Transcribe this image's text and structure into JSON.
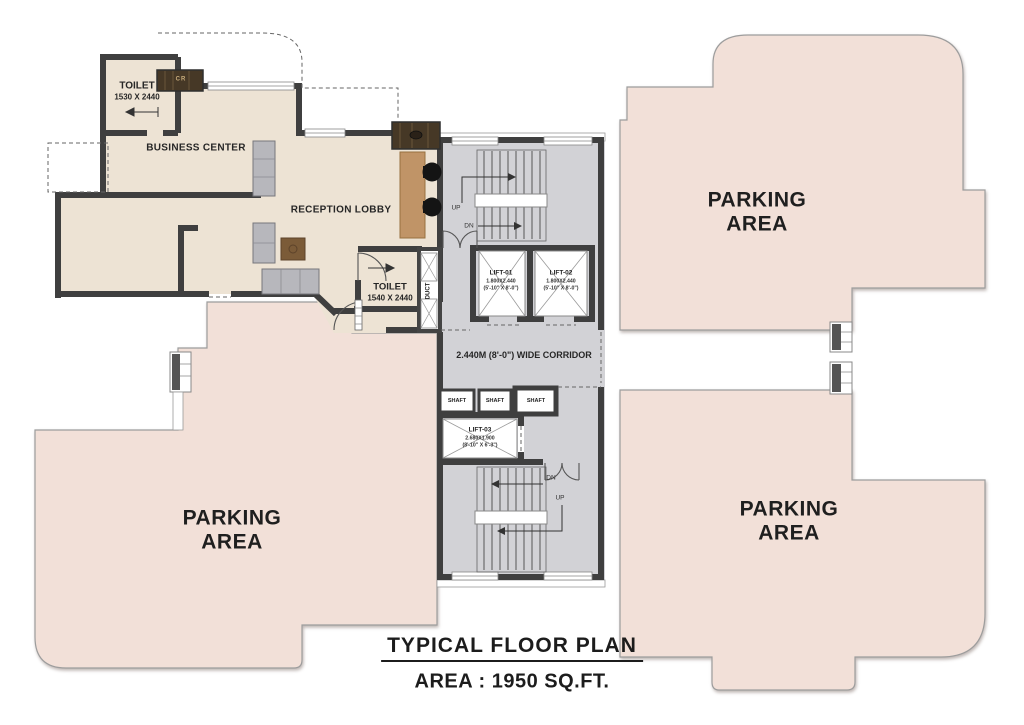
{
  "plan": {
    "title": "TYPICAL FLOOR PLAN",
    "area_text": "AREA : 1950 SQ.FT.",
    "rooms": {
      "toilet_top": {
        "name": "TOILET",
        "dims": "1530 X 2440"
      },
      "business_center": {
        "name": "BUSINESS CENTER"
      },
      "reception_lobby": {
        "name": "RECEPTION LOBBY"
      },
      "toilet_lobby": {
        "name": "TOILET",
        "dims": "1540 X 2440"
      },
      "duct_label": "DUCT",
      "corridor_label": "2.440M (8'-0\") WIDE CORRIDOR",
      "counter_label": "CR"
    },
    "lifts": [
      {
        "id": "LIFT-01",
        "dims_m": "1.800X2.440",
        "dims_ft": "(5'-10\" X 8'-0\")"
      },
      {
        "id": "LIFT-02",
        "dims_m": "1.800X2.440",
        "dims_ft": "(5'-10\" X 8'-0\")"
      },
      {
        "id": "LIFT-03",
        "dims_m": "2.680X1.900",
        "dims_ft": "(8'-10\" X 6'-3\")"
      }
    ],
    "shafts": [
      "SHAFT",
      "SHAFT",
      "SHAFT"
    ],
    "stair_labels": {
      "top_up": "UP",
      "top_dn": "DN",
      "bottom_dn": "DN",
      "bottom_up": "UP"
    },
    "parking": [
      {
        "line1": "PARKING",
        "line2": "AREA"
      },
      {
        "line1": "PARKING",
        "line2": "AREA"
      },
      {
        "line1": "PARKING",
        "line2": "AREA"
      }
    ],
    "colors": {
      "parking_fill": "#f2e0d8",
      "room_fill": "#ede3d4",
      "core_fill": "#d2d2d6",
      "wall": "#3f3f3f",
      "wood_desk": "#c09467",
      "wood_counter": "#463826"
    }
  }
}
